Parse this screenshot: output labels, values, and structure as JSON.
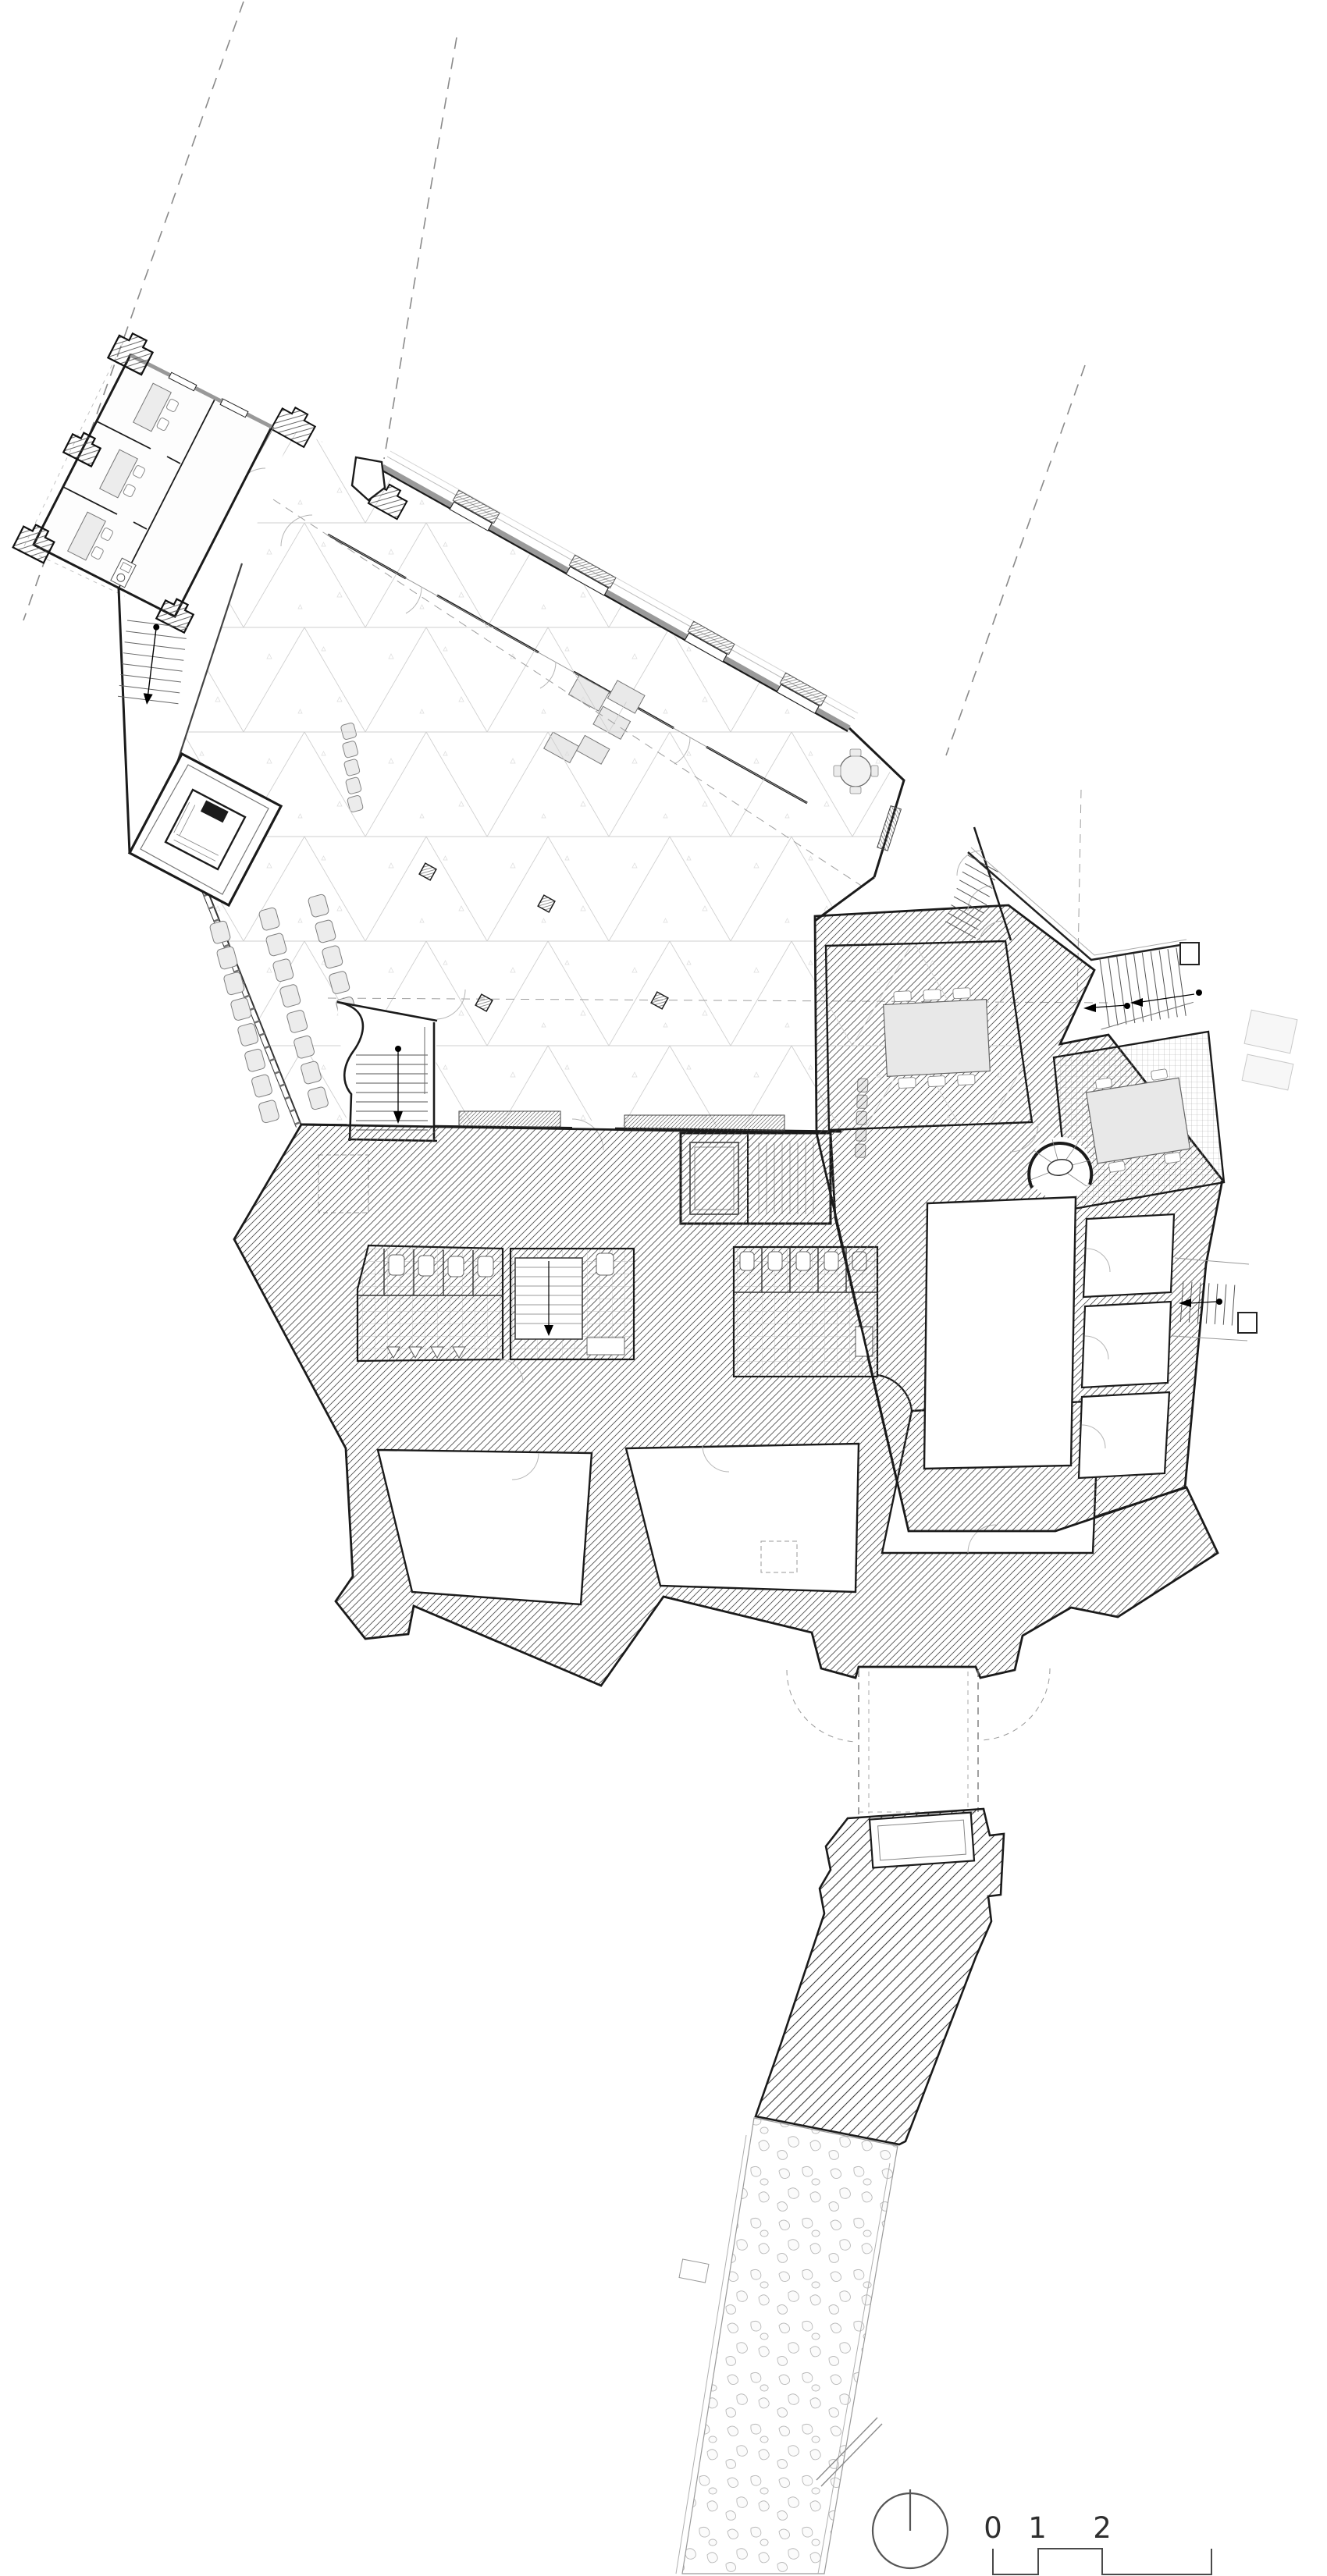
{
  "drawing": {
    "kind": "architectural-ground-floor-plan",
    "visible_text_note": "only scale bar numerals are printed on the sheet"
  },
  "scale_bar": {
    "labels": [
      "0",
      "1",
      "2",
      "5"
    ]
  },
  "north_indicator": {
    "icon": "north-dial-icon"
  },
  "colors": {
    "paper": "#ffffff",
    "ink": "#1b1b1b",
    "medium_line": "#555555",
    "light_line": "#9a9a9a",
    "grid_line": "#cfcfcf",
    "furniture_fill": "#ececec",
    "hatch_line": "#4a4a4a"
  }
}
